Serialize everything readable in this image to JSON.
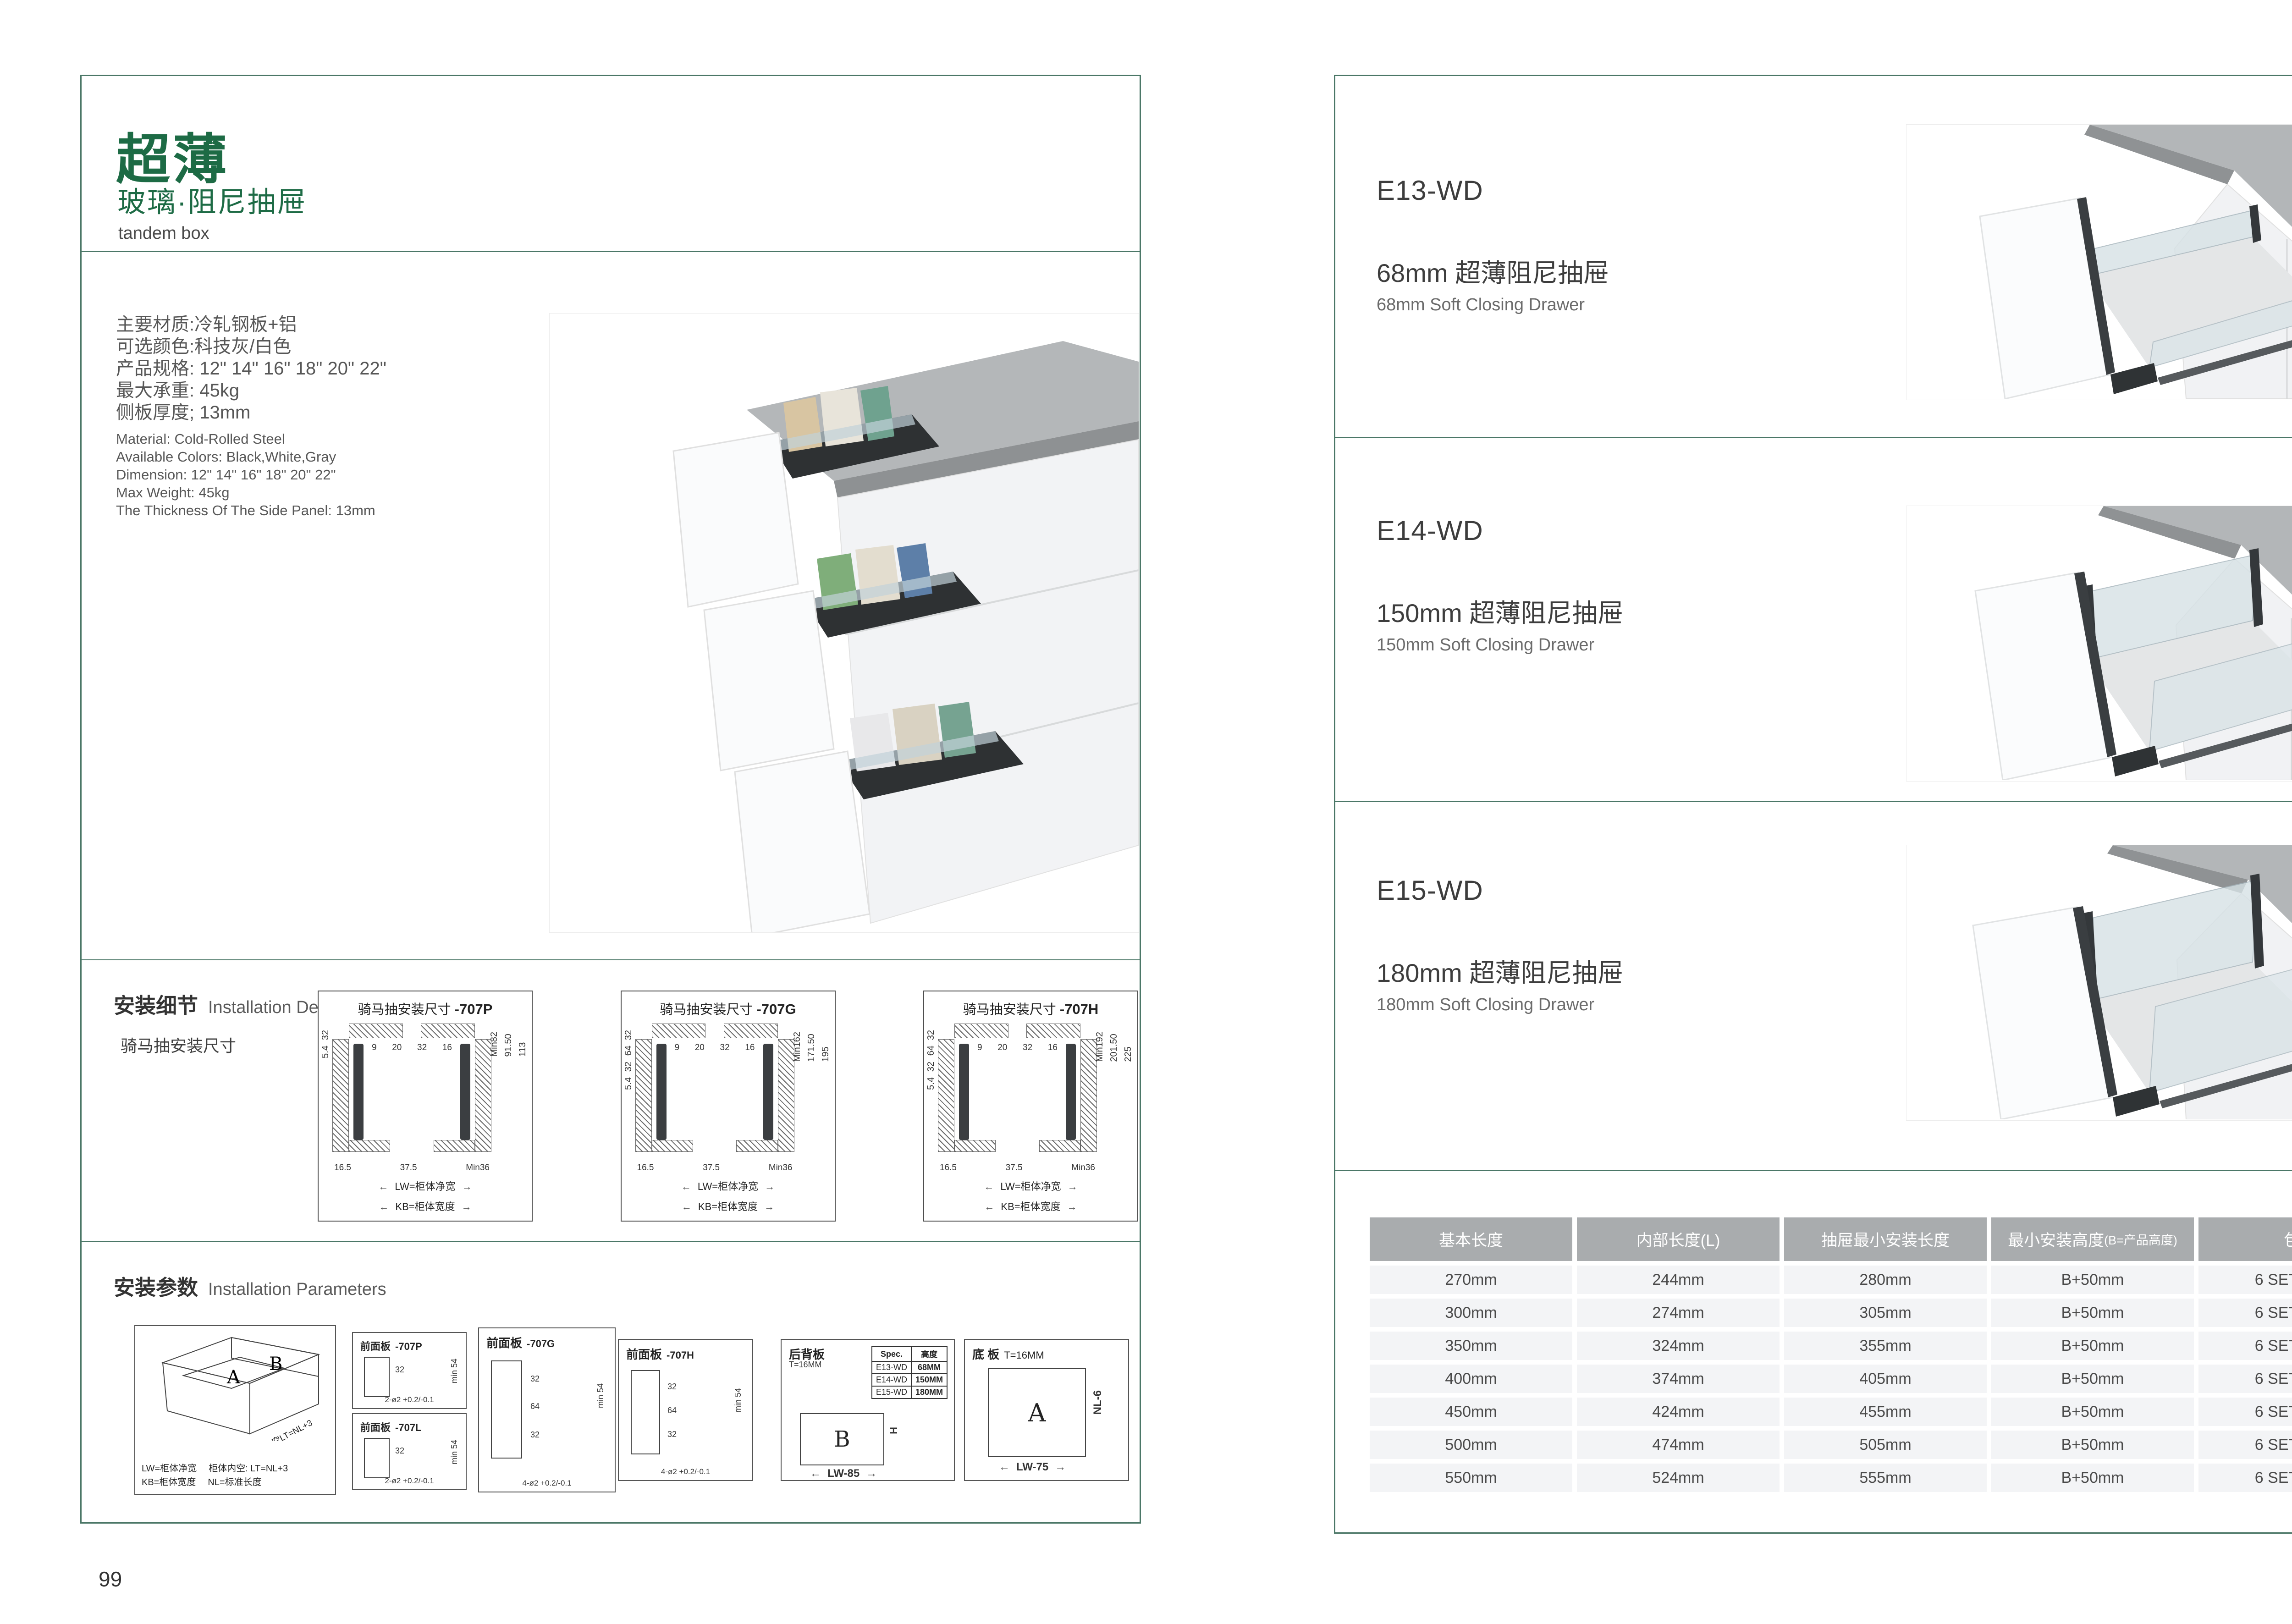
{
  "colors": {
    "brand_green": "#1d6b45",
    "line_green": "#4b7767",
    "table_header_bg": "#a9acae",
    "table_row_bg": "#f3f4f6"
  },
  "page_left": {
    "page_number": "99",
    "title": "超薄",
    "subtitle": "玻璃·阻尼抽屉",
    "category_en": "tandem box",
    "specs_cn": [
      "主要材质:冷轧钢板+铝",
      "可选颜色:科技灰/白色",
      "产品规格: 12\" 14\" 16\" 18\" 20\" 22\"",
      "最大承重: 45kg",
      "侧板厚度; 13mm"
    ],
    "specs_en": [
      "Material: Cold-Rolled Steel",
      "Available Colors: Black,White,Gray",
      "Dimension: 12\" 14\" 16\" 18\" 20\" 22\"",
      "Max Weight: 45kg",
      "The Thickness Of The Side Panel: 13mm"
    ],
    "install_details": {
      "heading_cn": "安装细节",
      "heading_en": "Installation Details",
      "sub_label": "骑马抽安装尺寸",
      "diagrams": [
        {
          "title": "骑马抽安装尺寸",
          "code": "-707P",
          "left_dims": [
            "32",
            "5.4"
          ],
          "right_dims": [
            "Min82",
            "91.50",
            "113"
          ],
          "inner_dims": [
            "9",
            "20",
            "32",
            "16"
          ],
          "bottom_dims": [
            "16.5",
            "37.5",
            "Min36"
          ],
          "width_labels": [
            "LW=柜体净宽",
            "KB=柜体宽度"
          ]
        },
        {
          "title": "骑马抽安装尺寸",
          "code": "-707G",
          "left_dims": [
            "32",
            "64",
            "32",
            "5.4"
          ],
          "right_dims": [
            "Min162",
            "171.50",
            "195"
          ],
          "inner_dims": [
            "9",
            "20",
            "32",
            "16"
          ],
          "bottom_dims": [
            "16.5",
            "37.5",
            "Min36"
          ],
          "width_labels": [
            "LW=柜体净宽",
            "KB=柜体宽度"
          ]
        },
        {
          "title": "骑马抽安装尺寸",
          "code": "-707H",
          "left_dims": [
            "32",
            "64",
            "32",
            "5.4"
          ],
          "right_dims": [
            "Min192",
            "201.50",
            "225"
          ],
          "inner_dims": [
            "9",
            "20",
            "32",
            "16"
          ],
          "bottom_dims": [
            "16.5",
            "37.5",
            "Min36"
          ],
          "width_labels": [
            "LW=柜体净宽",
            "KB=柜体宽度"
          ]
        }
      ]
    },
    "install_params": {
      "heading_cn": "安装参数",
      "heading_en": "Installation Parameters",
      "iso": {
        "a": "A",
        "b": "B",
        "slant_label": "柜体内空LT=NL+3",
        "legend_rows": [
          [
            "LW=柜体净宽",
            "柜体内空: LT=NL+3"
          ],
          [
            "KB=柜体宽度",
            "NL=标准长度"
          ]
        ]
      },
      "front_panels": [
        {
          "title": "前面板",
          "code": "-707P",
          "dims": [
            "32"
          ],
          "min_label": "min 54",
          "holes": "2-ø2 +0.2/-0.1"
        },
        {
          "title": "前面板",
          "code": "-707L",
          "dims": [
            "32"
          ],
          "min_label": "min 54",
          "holes": "2-ø2 +0.2/-0.1"
        },
        {
          "title": "前面板",
          "code": "-707G",
          "dims": [
            "32",
            "64",
            "32"
          ],
          "min_label": "min 54",
          "holes": "4-ø2 +0.2/-0.1"
        },
        {
          "title": "前面板",
          "code": "-707H",
          "dims": [
            "32",
            "64",
            "32"
          ],
          "min_label": "min 54",
          "holes": "4-ø2 +0.2/-0.1"
        }
      ],
      "back_panel": {
        "title": "后背板",
        "thickness": "T=16MM",
        "spec_headers": [
          "Spec.",
          "高度"
        ],
        "spec_rows": [
          [
            "E13-WD",
            "68MM"
          ],
          [
            "E14-WD",
            "150MM"
          ],
          [
            "E15-WD",
            "180MM"
          ]
        ],
        "body_label": "B",
        "height_label": "H",
        "width_label": "LW-85"
      },
      "bottom_panel": {
        "title": "底 板",
        "thickness": "T=16MM",
        "body_label": "A",
        "length_label": "NL-6",
        "width_label": "LW-75"
      }
    }
  },
  "page_right": {
    "page_number": "100",
    "products": [
      {
        "code": "E13-WD",
        "name_cn": "68mm 超薄阻尼抽屉",
        "name_en": "68mm Soft Closing Drawer"
      },
      {
        "code": "E14-WD",
        "name_cn": "150mm 超薄阻尼抽屉",
        "name_en": "150mm Soft Closing Drawer"
      },
      {
        "code": "E15-WD",
        "name_cn": "180mm 超薄阻尼抽屉",
        "name_en": "180mm Soft Closing Drawer"
      }
    ],
    "table": {
      "headers": [
        {
          "label": "基本长度",
          "note": ""
        },
        {
          "label": "内部长度(L)",
          "note": ""
        },
        {
          "label": "抽屉最小安装长度",
          "note": ""
        },
        {
          "label": "最小安装高度",
          "note": "(B=产品高度)"
        },
        {
          "label": "包装",
          "note": ""
        }
      ],
      "rows": [
        [
          "270mm",
          "244mm",
          "280mm",
          "B+50mm",
          "6 SETC/TNB"
        ],
        [
          "300mm",
          "274mm",
          "305mm",
          "B+50mm",
          "6 SETC/TNB"
        ],
        [
          "350mm",
          "324mm",
          "355mm",
          "B+50mm",
          "6 SETC/TNB"
        ],
        [
          "400mm",
          "374mm",
          "405mm",
          "B+50mm",
          "6 SETC/TNB"
        ],
        [
          "450mm",
          "424mm",
          "455mm",
          "B+50mm",
          "6 SETC/TNB"
        ],
        [
          "500mm",
          "474mm",
          "505mm",
          "B+50mm",
          "6 SETC/TNB"
        ],
        [
          "550mm",
          "524mm",
          "555mm",
          "B+50mm",
          "6 SETC/TNB"
        ]
      ]
    }
  }
}
